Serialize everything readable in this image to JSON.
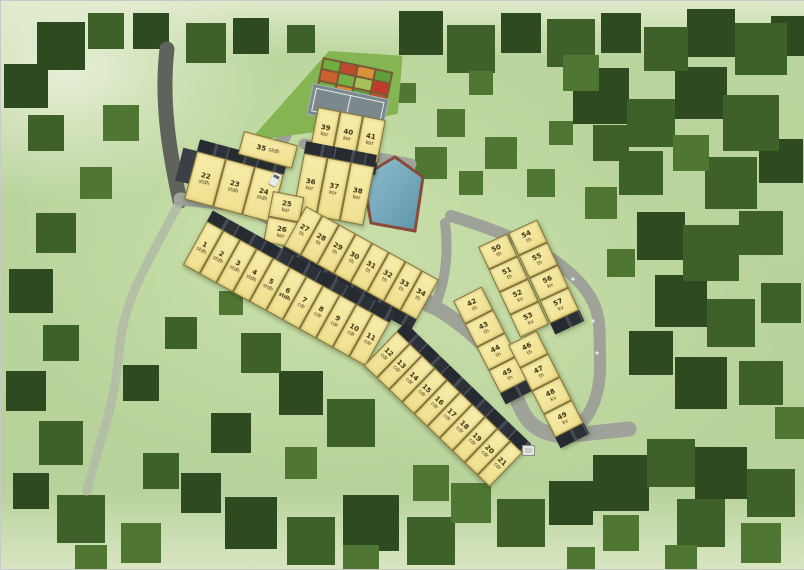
{
  "site_plan": {
    "palette": {
      "lot_fill": "#efdf8e",
      "lot_border": "#857536",
      "lot_text": "#3f3413",
      "road": "#9ea298",
      "entry_road": "#60635c",
      "path": "#b3bca6",
      "grass": "#b7d29a",
      "hedge": "#85b452",
      "court": "#7b898c",
      "pool_water": "#79afc2",
      "pool_deck": "#8a4a3c",
      "roof": "#262b31"
    },
    "amenities": {
      "tennis_court": "tennis-court",
      "community_garden": "garden-plots",
      "swimming_pool": "swimming-pool",
      "gazebo": "gazebo",
      "hedge": "hedge-boundary"
    },
    "lot_blocks": {
      "b1_1_11": [
        {
          "num": "1",
          "type": "stdh"
        },
        {
          "num": "2",
          "type": "stdh"
        },
        {
          "num": "3",
          "type": "stdh"
        },
        {
          "num": "4",
          "type": "stdh"
        },
        {
          "num": "5",
          "type": "stdh"
        },
        {
          "num": "6",
          "type": "stdh",
          "cls": "bold"
        },
        {
          "num": "7",
          "type": "cdr"
        },
        {
          "num": "8",
          "type": "cdr"
        },
        {
          "num": "9",
          "type": "cdr"
        },
        {
          "num": "10",
          "type": "cdr"
        },
        {
          "num": "11",
          "type": "cdr"
        }
      ],
      "b2_12_21": [
        {
          "num": "12",
          "type": "cdr"
        },
        {
          "num": "13",
          "type": "cdr"
        },
        {
          "num": "14",
          "type": "cdr"
        },
        {
          "num": "15",
          "type": "cdr"
        },
        {
          "num": "16",
          "type": "cdr"
        },
        {
          "num": "17",
          "type": "cdr"
        },
        {
          "num": "18",
          "type": "cdr"
        },
        {
          "num": "19",
          "type": "cdr"
        },
        {
          "num": "20",
          "type": "cdr"
        },
        {
          "num": "21",
          "type": "cdr"
        }
      ],
      "b3_22_24": [
        {
          "num": "22",
          "type": "stdh"
        },
        {
          "num": "23",
          "type": "stdh"
        },
        {
          "num": "24",
          "type": "stdh"
        }
      ],
      "b4_35": [
        {
          "num": "35",
          "type": "stdh"
        }
      ],
      "b5_36_38": [
        {
          "num": "36",
          "type": "kor"
        },
        {
          "num": "37",
          "type": "kor"
        },
        {
          "num": "38",
          "type": "kor"
        }
      ],
      "b6_39_41": [
        {
          "num": "39",
          "type": "kor"
        },
        {
          "num": "40",
          "type": "kor"
        },
        {
          "num": "41",
          "type": "kor"
        }
      ],
      "b7_25_26": [
        {
          "num": "25",
          "type": "kor"
        },
        {
          "num": "26",
          "type": "kor"
        }
      ],
      "b8_27_34": [
        {
          "num": "27",
          "type": "th"
        },
        {
          "num": "28",
          "type": "th"
        },
        {
          "num": "29",
          "type": "th"
        },
        {
          "num": "30",
          "type": "th"
        },
        {
          "num": "31",
          "type": "th"
        },
        {
          "num": "32",
          "type": "th"
        },
        {
          "num": "33",
          "type": "th"
        },
        {
          "num": "34",
          "type": "th"
        }
      ],
      "b9_50_53": [
        {
          "num": "50",
          "type": "th"
        },
        {
          "num": "51",
          "type": "th"
        },
        {
          "num": "52",
          "type": "kv"
        },
        {
          "num": "53",
          "type": "kv"
        }
      ],
      "b9_54_57": [
        {
          "num": "54",
          "type": "th"
        },
        {
          "num": "55",
          "type": "th"
        },
        {
          "num": "56",
          "type": "kv"
        },
        {
          "num": "57",
          "type": "kv"
        }
      ],
      "b10_42_45": [
        {
          "num": "42",
          "type": "th"
        },
        {
          "num": "43",
          "type": "th"
        },
        {
          "num": "44",
          "type": "th"
        },
        {
          "num": "45",
          "type": "th"
        }
      ],
      "b10_46_49": [
        {
          "num": "46",
          "type": "th"
        },
        {
          "num": "47",
          "type": "th"
        },
        {
          "num": "48",
          "type": "kv"
        },
        {
          "num": "49",
          "type": "kv"
        }
      ]
    }
  }
}
